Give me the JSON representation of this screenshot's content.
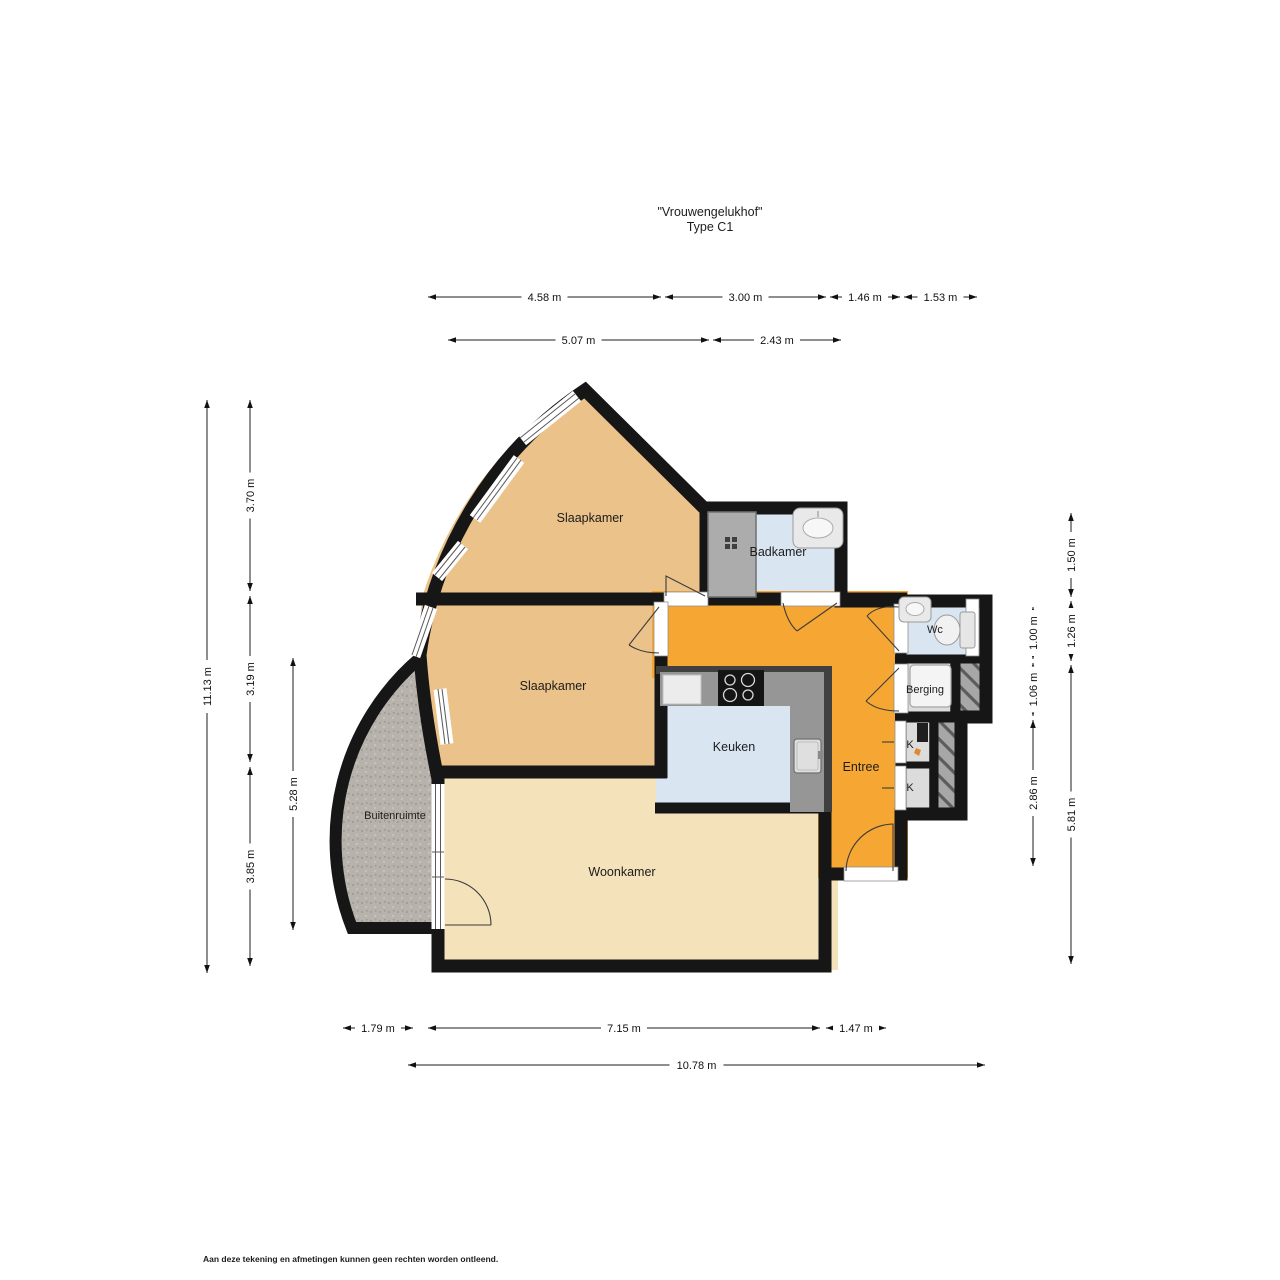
{
  "title": {
    "line1": "\"Vrouwengelukhof\"",
    "line2": "Type C1"
  },
  "rooms": {
    "slaapkamer_top": "Slaapkamer",
    "badkamer": "Badkamer",
    "slaapkamer_mid": "Slaapkamer",
    "keuken": "Keuken",
    "entree": "Entree",
    "wc": "Wc",
    "berging": "Berging",
    "kast_1": "K",
    "kast_2": "K",
    "woonkamer": "Woonkamer",
    "buitenruimte": "Buitenruimte"
  },
  "dimensions": {
    "top_row1": [
      "4.58 m",
      "3.00 m",
      "1.46 m",
      "1.53 m"
    ],
    "top_row2": [
      "5.07 m",
      "2.43 m"
    ],
    "left_outer": [
      "11.13 m"
    ],
    "left_mid": [
      "3.70 m",
      "3.19 m",
      "3.85 m"
    ],
    "left_inner": [
      "5.28 m"
    ],
    "right_inner": [
      "1.00 m",
      "1.06 m",
      "2.86 m"
    ],
    "right_outer": [
      "1.50 m",
      "1.26 m",
      "5.81 m"
    ],
    "bottom_row1": [
      "1.79 m",
      "7.15 m",
      "1.47 m"
    ],
    "bottom_row2": [
      "10.78 m"
    ]
  },
  "footer": "Aan deze tekening en afmetingen kunnen geen rechten worden ontleend.",
  "colors": {
    "wall": "#161616",
    "bedroom": "#ebc28a",
    "living": "#f3e2ba",
    "entry": "#f6a733",
    "wet_room": "#d9e5f1",
    "storage": "#dcdcdc",
    "outdoor": "#b6b1a9",
    "counter": "#969696",
    "shower": "#acacac"
  }
}
